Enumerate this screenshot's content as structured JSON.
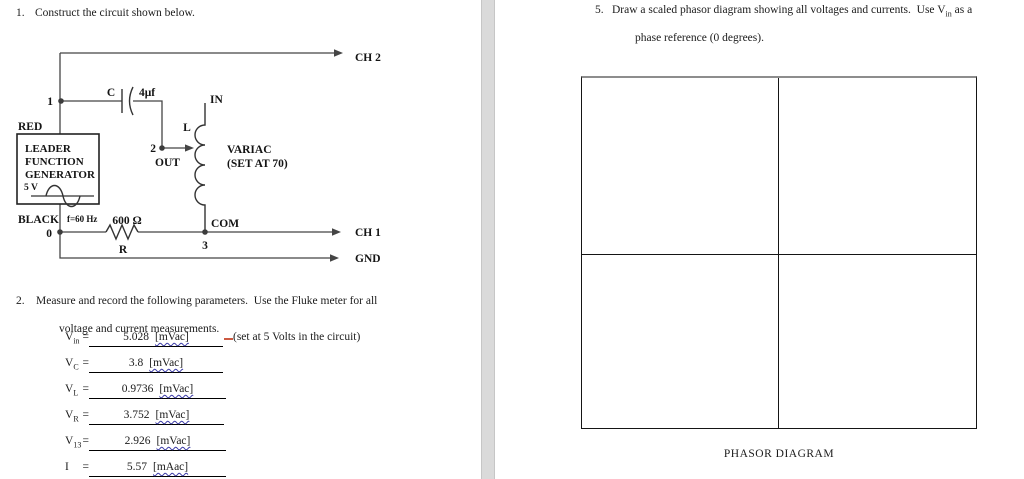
{
  "left_page": {
    "q1": {
      "number": "1.",
      "text": "Construct the circuit shown below."
    },
    "circuit": {
      "ch2": "CH 2",
      "ch1": "CH 1",
      "gnd": "GND",
      "node1": "1",
      "node2": "2",
      "node3": "3",
      "node0": "0",
      "red": "RED",
      "black": "BLACK",
      "cap_name": "C",
      "cap_value": "4μf",
      "in_label": "IN",
      "out_label": "OUT",
      "com_label": "COM",
      "inductor_name": "L",
      "variac_line1": "VARIAC",
      "variac_line2": "(SET AT 70)",
      "freq": "f=60 Hz",
      "resistor_value": "600 Ω",
      "resistor_name": "R",
      "gen_line1": "LEADER",
      "gen_line2": "FUNCTION",
      "gen_line3": "GENERATOR",
      "gen_voltage": "5 V"
    },
    "q2": {
      "number": "2.",
      "line1": "Measure and record the following parameters.  Use the Fluke meter for all",
      "line2": "voltage and current measurements."
    },
    "measurements": [
      {
        "sym": "V",
        "sub": "in",
        "eq": "=",
        "value": "5.028",
        "unit": "[mVac]",
        "note": "(set at 5 Volts in the circuit)"
      },
      {
        "sym": "V",
        "sub": "C",
        "eq": "=",
        "value": "3.8",
        "unit": "[mVac]"
      },
      {
        "sym": "V",
        "sub": "L",
        "eq": "=",
        "value": "0.9736",
        "unit": "[mVac]"
      },
      {
        "sym": "V",
        "sub": "R",
        "eq": "=",
        "value": "3.752",
        "unit": "[mVac]"
      },
      {
        "sym": "V",
        "sub": "13",
        "eq": "=",
        "value": "2.926",
        "unit": "[mVac]"
      },
      {
        "sym": "I",
        "sub": "",
        "eq": "=",
        "value": "5.57",
        "unit": "[mAac]"
      }
    ]
  },
  "right_page": {
    "q5": {
      "number": "5.",
      "line1_pre": "Draw a scaled phasor diagram showing all voltages and currents.  Use V",
      "line1_sub": "in",
      "line1_post": " as a",
      "line2": "phase reference (0 degrees)."
    },
    "phasor_caption": "PHASOR DIAGRAM"
  },
  "colors": {
    "spellcheck_wavy": "#3a3aa6",
    "grammar_mark": "#cc5a42",
    "page_gap": "#dadada",
    "ink": "#1b1b1b"
  }
}
